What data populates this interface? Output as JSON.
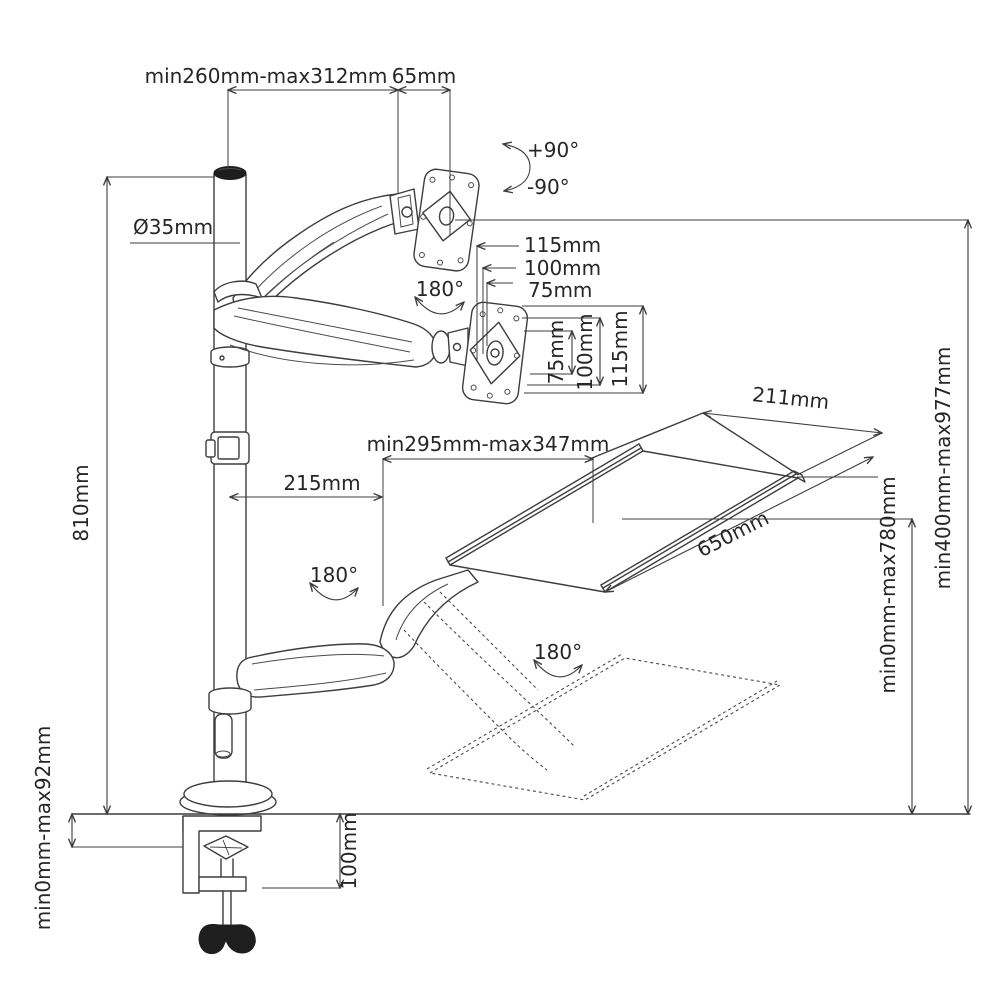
{
  "title": "Gas-spring monitor arm with keyboard tray workstation - dimensional diagram",
  "colors": {
    "line": "#3d3d3d",
    "text": "#262626",
    "dark_fill": "#1e1e1e",
    "background": "#ffffff"
  },
  "labels": {
    "pole_extension_range": "min260mm-max312mm",
    "vesa_offset": "65mm",
    "tilt_up": "+90°",
    "tilt_down": "-90°",
    "pole_diameter": "Ø35mm",
    "pole_height": "810mm",
    "vesa_width_115": "115mm",
    "vesa_width_100": "100mm",
    "vesa_width_75": "75mm",
    "vesa_height_75": "75mm",
    "vesa_height_100": "100mm",
    "vesa_height_115": "115mm",
    "monitor_swivel": "180°",
    "arm_swivel": "180°",
    "tray_swivel": "180°",
    "arm_pivot_offset": "215mm",
    "tray_slide_range": "min295mm-max347mm",
    "tray_depth": "211mm",
    "tray_width": "650mm",
    "monitor_height_range": "min400mm-max977mm",
    "tray_height_range": "min0mm-max780mm",
    "desk_thickness_range": "min0mm-max92mm",
    "clamp_height": "100mm"
  }
}
